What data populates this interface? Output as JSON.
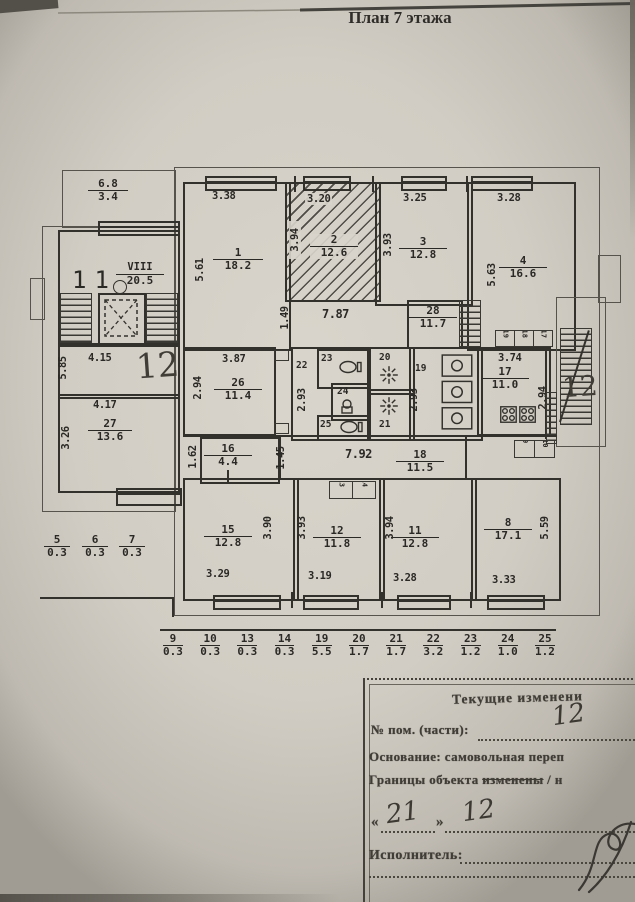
{
  "title": "План 7 этажа",
  "plan": {
    "balcony_top": {
      "n": "6.8",
      "a": "3.4"
    },
    "stairwell": {
      "apt_label": "11",
      "roman": "VIII",
      "area": "20.5",
      "width": "4.15",
      "height": "5.85",
      "hw_mark": "12"
    },
    "room27": {
      "name": "27",
      "area": "13.6",
      "width": "4.17",
      "height": "3.26"
    },
    "balcony_nums": [
      {
        "n": "5",
        "a": "0.3"
      },
      {
        "n": "6",
        "a": "0.3"
      },
      {
        "n": "7",
        "a": "0.3"
      }
    ],
    "room1": {
      "name": "1",
      "area": "18.2",
      "width": "3.38",
      "height": "5.61"
    },
    "room2": {
      "name": "2",
      "area": "12.6",
      "width": "3.20",
      "height": "3.94"
    },
    "room3": {
      "name": "3",
      "area": "12.8",
      "width": "3.25",
      "height": "3.93"
    },
    "room4": {
      "name": "4",
      "area": "16.6",
      "width": "3.28",
      "height": "5.63"
    },
    "corridor_top": {
      "length": "7.87",
      "width": "1.49"
    },
    "room28": {
      "name": "28",
      "area": "11.7"
    },
    "room26": {
      "name": "26",
      "area": "11.4",
      "width": "3.87",
      "height": "2.94"
    },
    "room22": {
      "name": "22",
      "height": "2.93"
    },
    "room23": {
      "name": "23"
    },
    "room24": {
      "name": "24"
    },
    "room25": {
      "name": "25"
    },
    "room20": {
      "name": "20"
    },
    "room21": {
      "name": "21"
    },
    "room19": {
      "name": "19",
      "height": "2.93"
    },
    "room17": {
      "name": "17",
      "area": "11.0",
      "width": "3.74",
      "height": "2.94"
    },
    "closets_top": [
      "19",
      "18",
      "17"
    ],
    "fire_escape_mark": "12",
    "room16": {
      "name": "16",
      "area": "4.4",
      "height": "1.62"
    },
    "corridor_bottom": {
      "length": "7.92",
      "width": "1.45"
    },
    "room18": {
      "name": "18",
      "area": "11.5"
    },
    "room15": {
      "name": "15",
      "area": "12.8",
      "width": "3.29",
      "height": "3.90"
    },
    "room12": {
      "name": "12",
      "area": "11.8",
      "width": "3.19",
      "height": "3.93"
    },
    "room11": {
      "name": "11",
      "area": "12.8",
      "width": "3.28",
      "height": "3.94"
    },
    "room8": {
      "name": "8",
      "area": "17.1",
      "width": "3.33",
      "height": "5.59"
    },
    "closets_12": [
      "13",
      "14"
    ],
    "closets_8": [
      "9",
      "10"
    ],
    "legend_row": [
      {
        "n": "9",
        "a": "0.3"
      },
      {
        "n": "10",
        "a": "0.3"
      },
      {
        "n": "13",
        "a": "0.3"
      },
      {
        "n": "14",
        "a": "0.3"
      },
      {
        "n": "19",
        "a": "5.5"
      },
      {
        "n": "20",
        "a": "1.7"
      },
      {
        "n": "21",
        "a": "1.7"
      },
      {
        "n": "22",
        "a": "3.2"
      },
      {
        "n": "23",
        "a": "1.2"
      },
      {
        "n": "24",
        "a": "1.0"
      },
      {
        "n": "25",
        "a": "1.2"
      }
    ]
  },
  "form": {
    "title": "Текущие изменени",
    "room_label": "№ пом. (части):",
    "room_value": "12",
    "basis": "Основание: самовольная переп",
    "borders_prefix": "Границы объекта ",
    "borders_struck": "изменены",
    "borders_suffix": " / н",
    "date_open": "«",
    "date_day": "21",
    "date_close": "»",
    "date_month": "12",
    "executor_label": "Исполнитель:"
  },
  "icons": {
    "elevator": "dashed-x-box",
    "toilet": "wc-bowl",
    "shower": "spray-star",
    "stove": "burner-grid",
    "sink": "basin",
    "stairs": "hatched-flight",
    "ladder": "diagonal-fire-escape",
    "signature": "cursive-flourish"
  },
  "colors": {
    "ink": "#33312c",
    "paper": "#d7d3ca",
    "stamp": "#403d37"
  }
}
